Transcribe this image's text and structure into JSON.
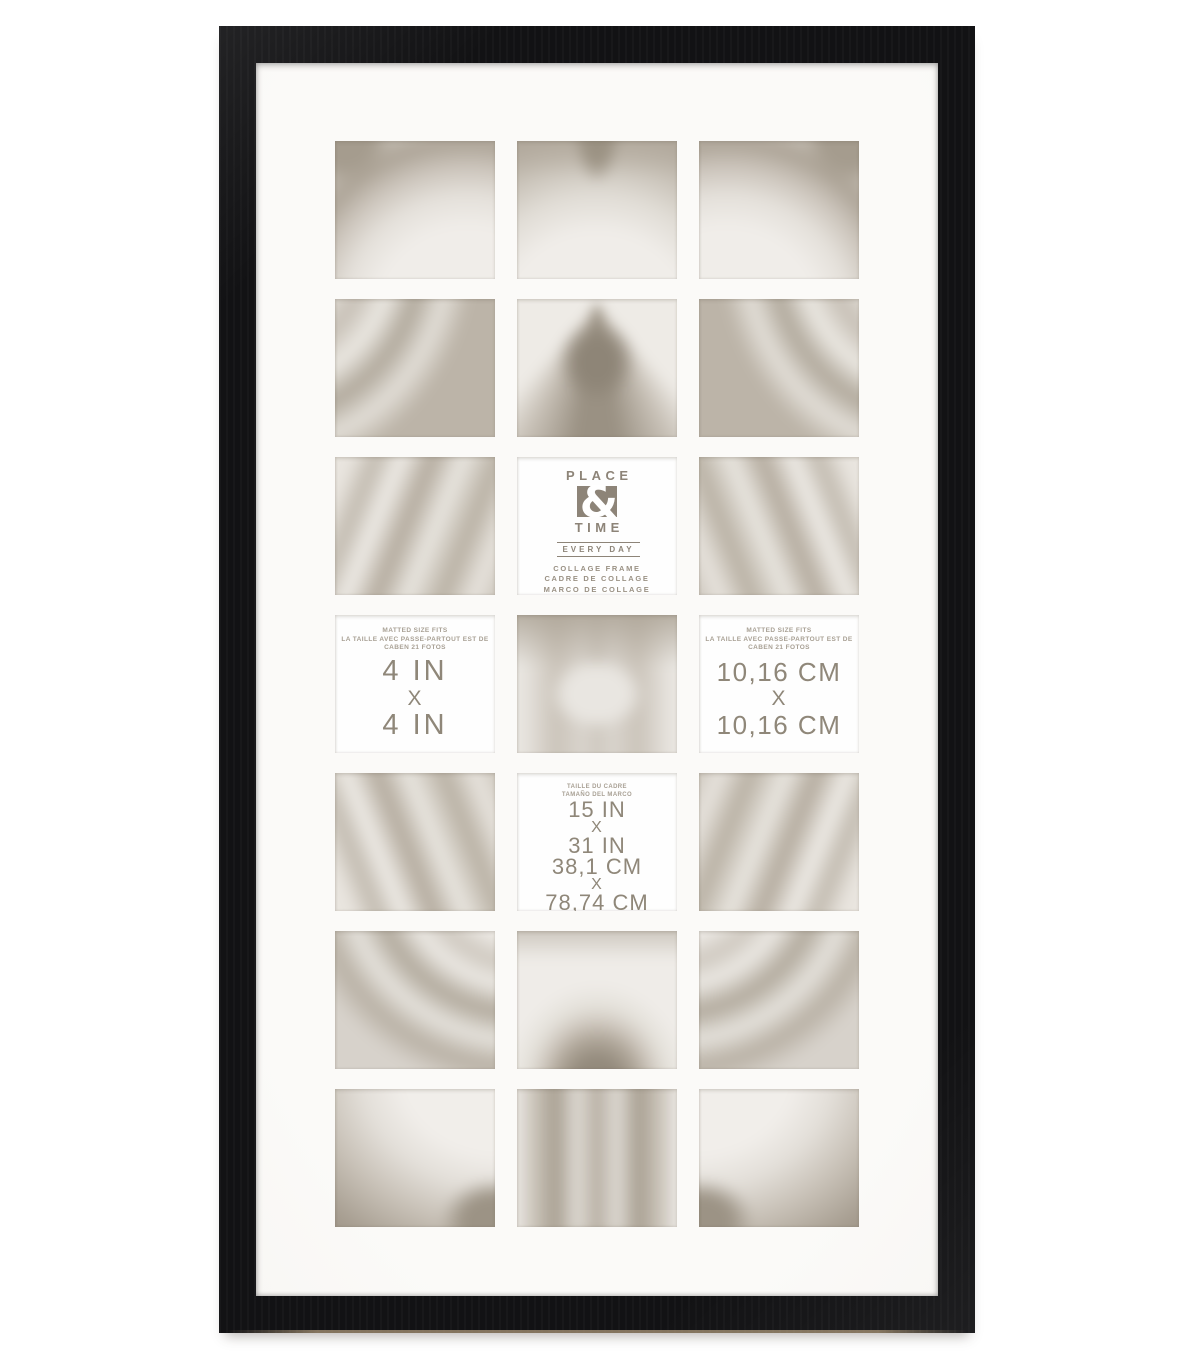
{
  "colors": {
    "background": "#ffffff",
    "frame_black": "#121214",
    "mat_white": "#faf9f7",
    "card_white": "#fefefe",
    "brand_taupe": "#8d8478",
    "photo_light_gray": "#f0ede9",
    "photo_dark_gray": "#a29a8d"
  },
  "brand_card": {
    "name_top": "PLACE",
    "ampersand": "&",
    "name_bottom": "TIME",
    "tagline": "EVERY DAY",
    "product_lines": [
      "COLLAGE FRAME",
      "CADRE DE COLLAGE",
      "MARCO DE COLLAGE"
    ]
  },
  "matted_size": {
    "header": [
      "MATTED SIZE FITS",
      "LA TAILLE AVEC PASSE-PARTOUT EST DE",
      "CABEN 21 FOTOS"
    ],
    "inches": [
      "4 IN",
      "X",
      "4 IN"
    ],
    "centimeters": [
      "10,16 CM",
      "X",
      "10,16 CM"
    ]
  },
  "frame_size": {
    "header": [
      "TAILLE DU CADRE",
      "TAMAÑO DEL MARCO"
    ],
    "values": [
      "15 IN",
      "X",
      "31 IN",
      "38,1 CM",
      "X",
      "78,74 CM"
    ]
  }
}
